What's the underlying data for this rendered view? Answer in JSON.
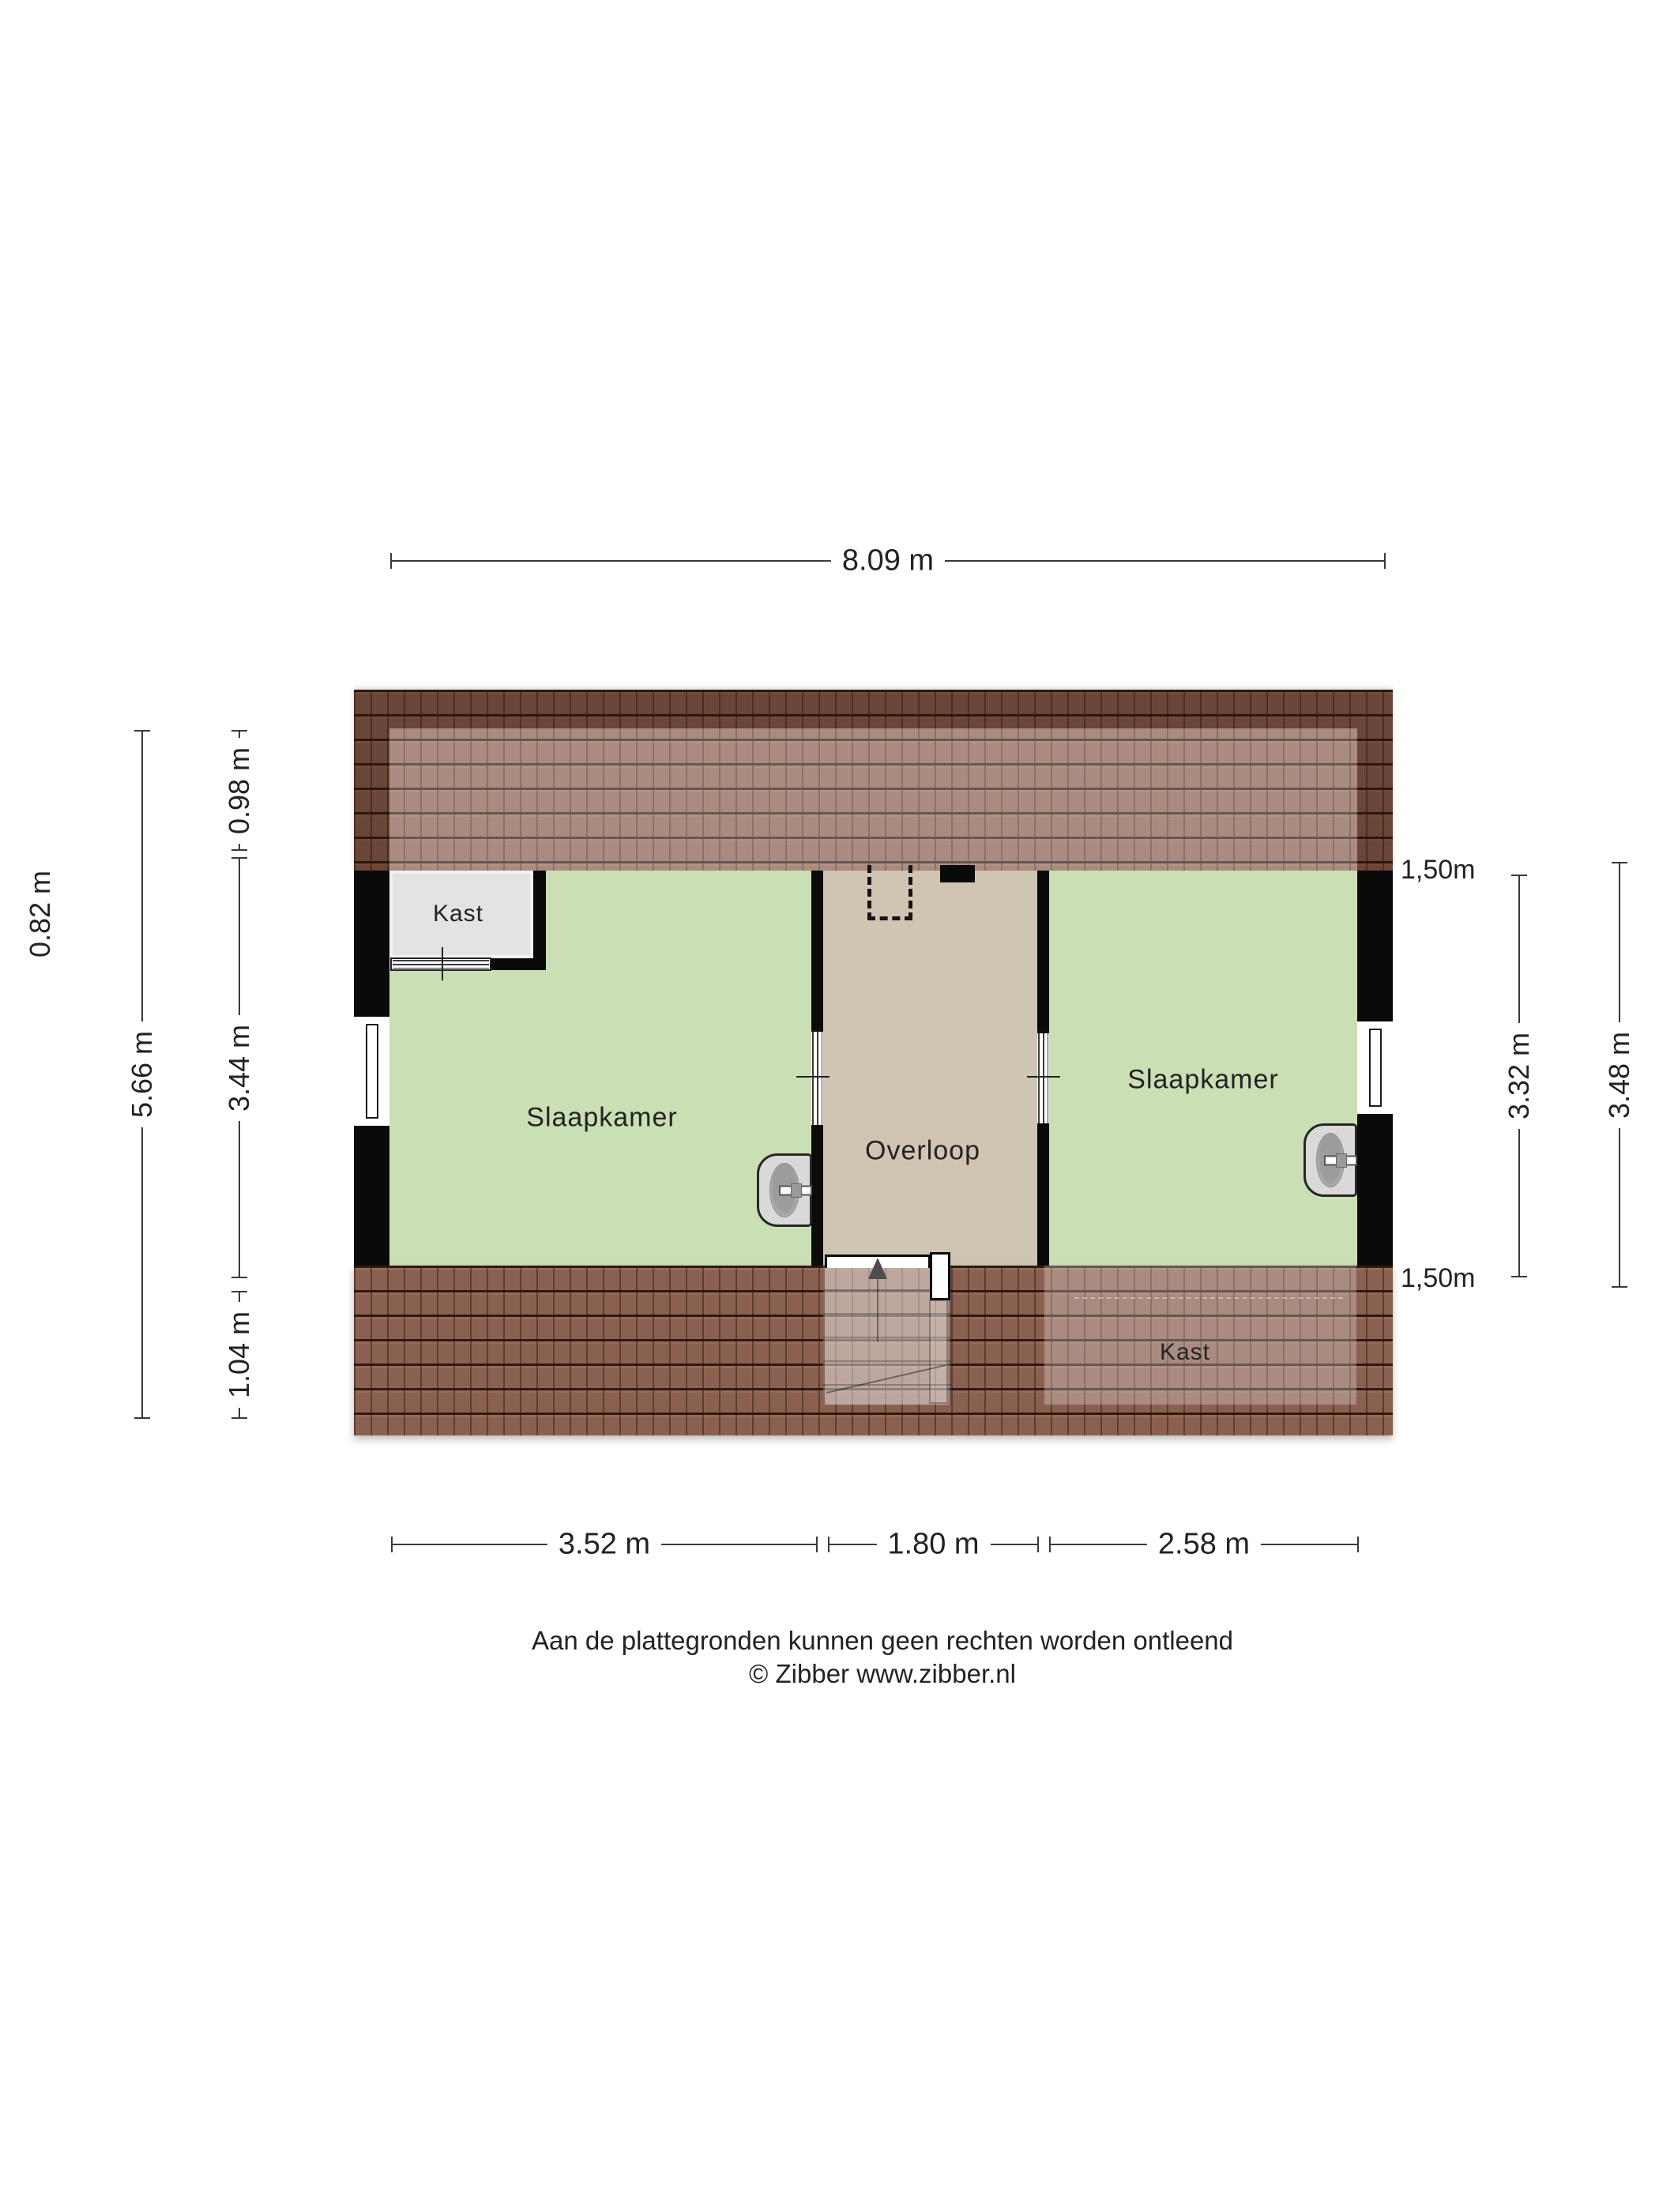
{
  "plan": {
    "rooms": {
      "closet_top": {
        "label": "Kast"
      },
      "bedroom_left": {
        "label": "Slaapkamer"
      },
      "landing": {
        "label": "Overloop"
      },
      "bedroom_right": {
        "label": "Slaapkamer"
      },
      "closet_bottom": {
        "label": "Kast"
      }
    }
  },
  "dimensions": {
    "top_width": {
      "label": "8.09 m"
    },
    "left_overhang": {
      "label": "0.82 m"
    },
    "left_total": {
      "label": "5.66 m"
    },
    "left_top": {
      "label": "0.98 m"
    },
    "left_middle": {
      "label": "3.44 m"
    },
    "left_bottom": {
      "label": "1.04 m"
    },
    "right_knee_top": {
      "label": "1,50m"
    },
    "right_inner": {
      "label": "3.32 m"
    },
    "right_outer": {
      "label": "3.48 m"
    },
    "right_knee_bottom": {
      "label": "1,50m"
    },
    "bottom_left": {
      "label": "3.52 m"
    },
    "bottom_middle": {
      "label": "1.80 m"
    },
    "bottom_right": {
      "label": "2.58 m"
    }
  },
  "footer": {
    "disclaimer": "Aan de plattegronden kunnen geen rechten worden ontleend",
    "credit": "© Zibber www.zibber.nl"
  },
  "colors": {
    "room_green": "#cbdfb4",
    "floor_tan": "#cfc5b2",
    "closet_grey": "#e3e3e3",
    "roof_brown": "#8a6150",
    "wall_black": "#0a0a0a"
  }
}
